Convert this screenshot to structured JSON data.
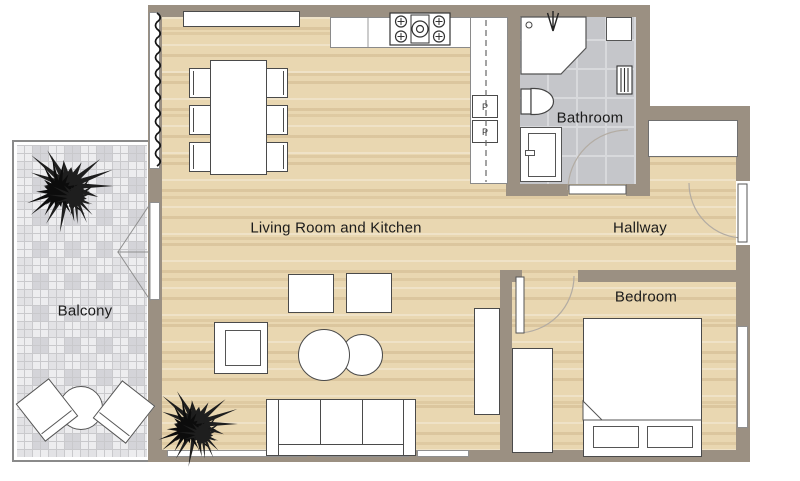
{
  "rooms": {
    "living": {
      "label": "Living Room and Kitchen"
    },
    "bathroom": {
      "label": "Bathroom"
    },
    "hallway": {
      "label": "Hallway"
    },
    "bedroom": {
      "label": "Bedroom"
    },
    "balcony": {
      "label": "Balcony"
    }
  },
  "kitchen": {
    "appliance_top_label": "P",
    "appliance_bottom_label": "P"
  },
  "colors": {
    "wall": "#9b9082",
    "floor": "#e9d7b1",
    "floor-stripe": "#d8c094",
    "bath-floor": "#c5c6ca",
    "bath-grout": "#d8d9dc",
    "balcony-tile": "#ededef",
    "balcony-grout": "#c9c9cc",
    "outline": "#4a4a4a",
    "label-color": "#1b1b1b"
  }
}
